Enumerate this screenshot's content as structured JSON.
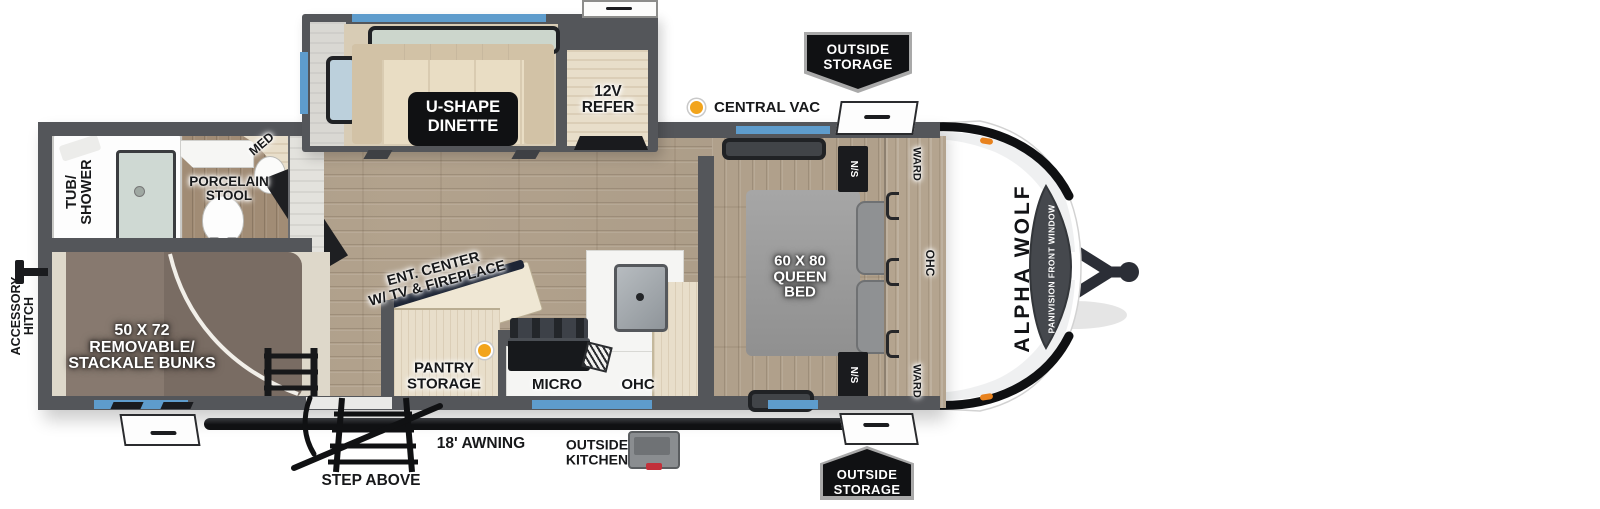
{
  "title": "Alpha Wolf travel trailer floor plan",
  "colors": {
    "wall": "#54565a",
    "ink": "#1a1b1e",
    "blue": "#5e9ccc",
    "orange": "#f2a41c",
    "floor": "#b2a28d",
    "slide-beige": "#d8ccb5",
    "bunkmat": "#87796f",
    "bedgray": "#9c9c9c",
    "capwhite": "#ffffff"
  },
  "callouts": {
    "outside_storage_top": {
      "lines": [
        "OUTSIDE",
        "STORAGE"
      ]
    },
    "outside_storage_bottom": {
      "lines": [
        "OUTSIDE",
        "STORAGE"
      ]
    },
    "central_vac": {
      "label": "CENTRAL VAC"
    },
    "refer": {
      "lines": [
        "12V",
        "REFER"
      ]
    },
    "dinette": {
      "lines": [
        "U-SHAPE",
        "DINETTE"
      ]
    },
    "tub_shower": {
      "lines": [
        "TUB/",
        "SHOWER"
      ]
    },
    "med": {
      "label": "MED"
    },
    "porcelain_stool": {
      "lines": [
        "PORCELAIN",
        "STOOL"
      ]
    },
    "accessory_hitch": {
      "lines": [
        "ACCESSORY",
        "HITCH"
      ]
    },
    "bunks": {
      "lines": [
        "50 X 72",
        "REMOVABLE/",
        "STACKALE BUNKS"
      ]
    },
    "ent_center": {
      "lines": [
        "ENT. CENTER",
        "W/ TV & FIREPLACE"
      ]
    },
    "pantry": {
      "lines": [
        "PANTRY",
        "STORAGE"
      ]
    },
    "micro": {
      "label": "MICRO"
    },
    "ohc_kitchen": {
      "label": "OHC"
    },
    "queen_bed": {
      "lines": [
        "60 X 80",
        "QUEEN",
        "BED"
      ]
    },
    "ns_top": {
      "label": "N/S"
    },
    "ns_bottom": {
      "label": "N/S"
    },
    "ward_top": {
      "label": "WARD"
    },
    "ward_bottom": {
      "label": "WARD"
    },
    "ohc_bedroom": {
      "label": "OHC"
    },
    "awning": {
      "label": "18' AWNING"
    },
    "outside_kitchen": {
      "lines": [
        "OUTSIDE",
        "KITCHEN"
      ]
    },
    "step_above": {
      "label": "STEP ABOVE"
    },
    "brand": {
      "label": "ALPHA WOLF"
    },
    "front_window": {
      "label": "PANIVISION FRONT WINDOW"
    }
  }
}
